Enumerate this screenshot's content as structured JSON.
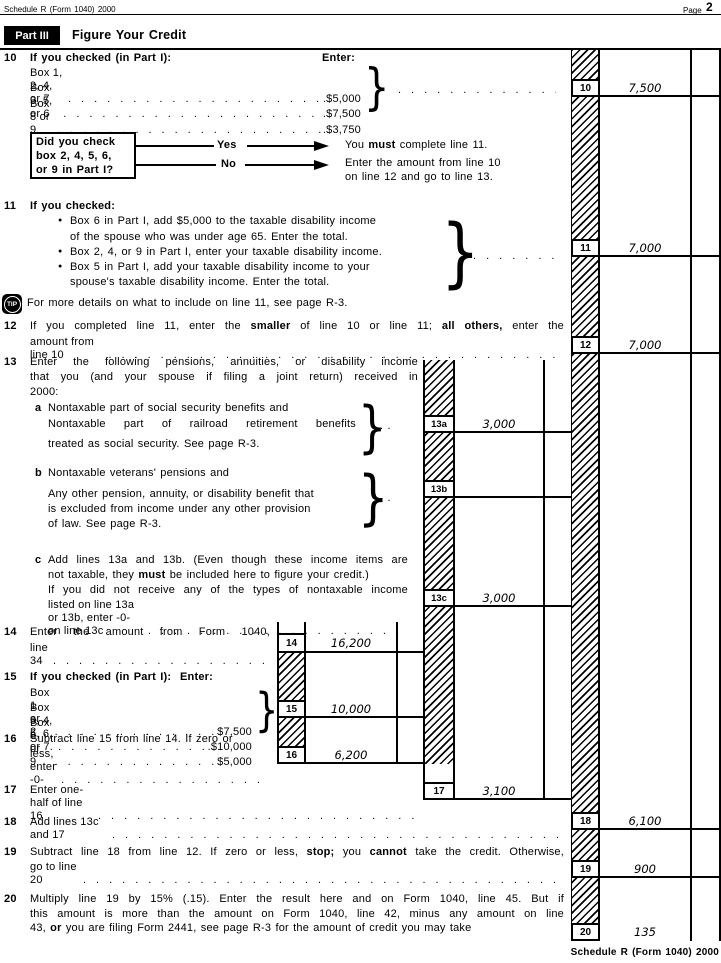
{
  "header": {
    "left": "Schedule R (Form 1040) 2000",
    "page_word": "Page",
    "page_num": "2"
  },
  "part3": {
    "badge": "Part III",
    "title": "Figure Your Credit"
  },
  "leader": "................................................",
  "dots2": ".  .",
  "brace": "}",
  "l10": {
    "num": "10",
    "head": "If you checked (in Part I):",
    "enter": "Enter:",
    "rows": [
      {
        "label": "Box 1, 2, 4, or 7",
        "amt": ".$5,000"
      },
      {
        "label": "Box 3, 5, or 6",
        "amt": ".$7,500"
      },
      {
        "label": "Box 8 or 9",
        "amt": ".$3,750"
      }
    ],
    "box": "10",
    "value": "7,500"
  },
  "flow": {
    "q1": "Did you check",
    "q2": "box 2, 4, 5, 6,",
    "q3": "or 9 in Part I?",
    "yes": "Yes",
    "no": "No",
    "yes_p1": "You ",
    "yes_b": "must",
    "yes_p2": " complete line 11.",
    "no_r1": "Enter the amount from line 10",
    "no_r2": "on line 12 and go to line 13."
  },
  "l11": {
    "num": "11",
    "head": "If you checked:",
    "bullet": "●",
    "b1a": "Box 6 in Part I, add $5,000 to the taxable disability income",
    "b1b": "of the spouse who was under age 65. Enter the total.",
    "b2": "Box 2, 4, or 9 in Part I, enter your taxable disability income.",
    "b3a": "Box 5 in Part I, add your taxable disability income to your",
    "b3b": "spouse's taxable disability income. Enter the total.",
    "box": "11",
    "value": "7,000"
  },
  "tip": {
    "label": "TIP",
    "text": "For more details on what to include on line 11, see page R-3."
  },
  "l12": {
    "num": "12",
    "r1p1": "If you completed line 11, enter the ",
    "r1b1": "smaller",
    "r1p2": " of line 10 or line 11; ",
    "r1b2": "all others,",
    "r1p3": " enter the",
    "r2": "amount from line 10",
    "box": "12",
    "value": "7,000"
  },
  "l13": {
    "num": "13",
    "r1": "Enter the following pensions, annuities, or disability income",
    "r2": "that you (and your spouse if filing a joint return) received in",
    "r3": "2000:"
  },
  "l13a": {
    "letter": "a",
    "r1": "Nontaxable part of social security benefits and",
    "r2": "Nontaxable part of railroad retirement benefits",
    "r3": "treated as social security. See page R-3.",
    "box": "13a",
    "value": "3,000"
  },
  "l13b": {
    "letter": "b",
    "r1": "Nontaxable veterans' pensions and",
    "r2": "Any other pension, annuity, or disability benefit that",
    "r3": "is excluded from income under any other provision",
    "r4": "of law. See page R-3.",
    "box": "13b"
  },
  "l13c": {
    "letter": "c",
    "r1": "Add lines 13a and 13b. (Even though these income items are",
    "r2p1": "not taxable, they ",
    "r2b": "must",
    "r2p2": " be included here to figure your credit.)",
    "r3": "If you did not receive any of the types of nontaxable income",
    "r4": "listed on line 13a or 13b, enter -0- on line 13c",
    "box": "13c",
    "value": "3,000"
  },
  "l14": {
    "num": "14",
    "r1": "Enter the amount from Form 1040,",
    "r2": "line 34",
    "box": "14",
    "value": "16,200"
  },
  "l15": {
    "num": "15",
    "head": "If you checked (in Part I):",
    "enter": "Enter:",
    "rows": [
      {
        "label": "Box 1 or 2",
        "amt": "$7,500"
      },
      {
        "label": "Box 3, 4, 5, 6, or 7.",
        "amt": ".$10,000"
      },
      {
        "label": "Box 8 or 9",
        "amt": "$5,000"
      }
    ],
    "box": "15",
    "value": "10,000"
  },
  "l16": {
    "num": "16",
    "r1": "Subtract line 15 from line 14. If zero or",
    "r2": "less, enter -0-",
    "box": "16",
    "value": "6,200"
  },
  "l17": {
    "num": "17",
    "r1": "Enter one-half of line 16",
    "box": "17",
    "value": "3,100"
  },
  "l18": {
    "num": "18",
    "r1": "Add lines 13c and 17",
    "box": "18",
    "value": "6,100"
  },
  "l19": {
    "num": "19",
    "r1p1": "Subtract line 18 from line 12. If zero or less, ",
    "r1b1": "stop;",
    "r1p2": " you ",
    "r1b2": "cannot",
    "r1p3": " take the credit. Otherwise,",
    "r2": "go to line 20",
    "box": "19",
    "value": "900"
  },
  "l20": {
    "num": "20",
    "r1": "Multiply line 19 by 15% (.15). Enter the result here and on Form 1040, line 45. But if",
    "r2": "this amount is more than the amount on Form 1040, line 42, minus any amount on line",
    "r3p1": "43, ",
    "r3b": "or",
    "r3p2": " you are filing Form 2441, see page R-3 for the amount of credit you may take",
    "box": "20",
    "value": "135"
  },
  "footer": "Schedule R (Form 1040) 2000"
}
